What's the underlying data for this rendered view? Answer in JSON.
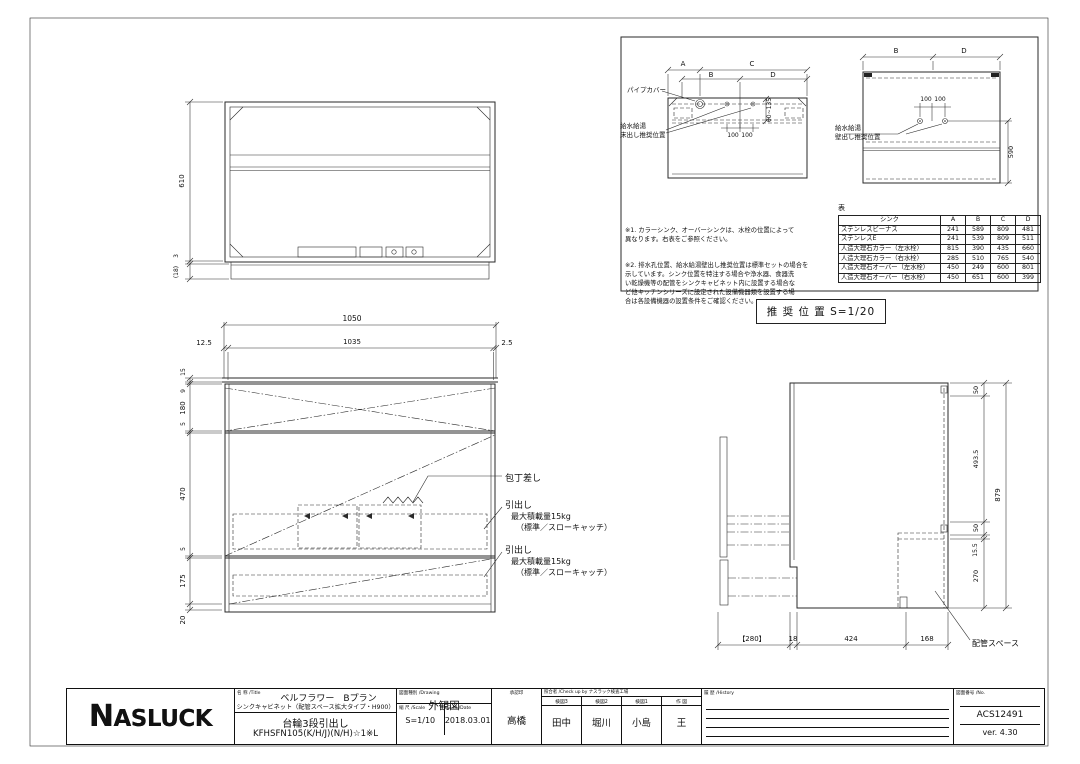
{
  "top_view": {
    "dim_height": "610",
    "dim_edge": "3",
    "dim_base": "(18)"
  },
  "front_view": {
    "dim_total_w": "1050",
    "dim_l": "12.5",
    "dim_inner_w": "1035",
    "dim_r": "2.5",
    "dims_left": [
      "15",
      "9",
      "180",
      "5",
      "470",
      "5",
      "175",
      "20"
    ],
    "label_knife": "包丁差し",
    "drawer_label": {
      "line1": "引出し",
      "line2": "最大積載量15kg",
      "line3": "（標準／スローキャッチ）"
    }
  },
  "side_view": {
    "dims_right": [
      "50",
      "493.5",
      "50",
      "15.5",
      "270"
    ],
    "dim_total_h": "879",
    "dims_bottom": [
      "【280】",
      "18",
      "424",
      "168"
    ],
    "label_piping": "配管スペース"
  },
  "recommend": {
    "caption": "推 奨 位 置  S=1/20",
    "floor": {
      "dim_a": "A",
      "dim_b": "B",
      "dim_c": "C",
      "dim_d": "D",
      "label_pipe_cover": "パイプカバー",
      "label_line1": "給水給湯",
      "label_line2": "床出し推奨位置",
      "dim_100": "100",
      "dim_range": "60~135"
    },
    "wall": {
      "dim_b": "B",
      "dim_d": "D",
      "label_line1": "給水給湯",
      "label_line2": "壁出し推奨位置",
      "dim_100": "100",
      "dim_height": "590"
    },
    "note1": "※1. カラーシンク、オーバーシンクは、水栓の位置によって\n異なります。右表をご参照ください。",
    "note2": "※2. 排水孔位置、給水給湯壁出し推奨位置は標準セットの場合を\n示しています。シンク位置を特注する場合や浄水器、食器洗\nい乾燥機等の配管をシンクキャビネット内に設置する場合な\nど他キッチンシリーズに設定された設備機器類を設置する場\n合は各設備機器の設置条件をご確認ください。",
    "table": {
      "caption": "表",
      "headers": [
        "シンク",
        "A",
        "B",
        "C",
        "D"
      ],
      "rows": [
        [
          "ステンレスビーナス",
          "241",
          "589",
          "809",
          "481"
        ],
        [
          "ステンレスE",
          "241",
          "539",
          "809",
          "511"
        ],
        [
          "人造大理石カラー（左水栓）",
          "815",
          "390",
          "435",
          "660"
        ],
        [
          "人造大理石カラー（右水栓）",
          "285",
          "510",
          "765",
          "540"
        ],
        [
          "人造大理石オーバー（左水栓）",
          "450",
          "249",
          "600",
          "801"
        ],
        [
          "人造大理石オーバー（右水栓）",
          "450",
          "651",
          "600",
          "399"
        ]
      ]
    }
  },
  "title_block": {
    "logo": "ASLUCK",
    "logo_initial": "N",
    "name_header": "名 称 /Title",
    "name_line1": "ベルフラワー　Bプラン",
    "name_line2": "シンクキャビネット（配管スペース拡大タイプ・H900）",
    "name_line3": "台輪3段引出し",
    "name_line4": "KFHSFN105(K/H/J)(N/H)☆1※L",
    "drawing_header": "図面種別 /Drawing",
    "drawing_type": "外観図",
    "scale_header": "縮 尺 /Scale",
    "scale_value": "S=1/10",
    "date_header": "日 付 /Date",
    "date_value": "2018.03.01",
    "approval_header": "承認印",
    "approval_name": "高橋",
    "check_header": "照合者 /Check up by ナスラック検査工場",
    "check_cols": [
      {
        "header": "検図3",
        "name": "田中"
      },
      {
        "header": "検図2",
        "name": "堀川"
      },
      {
        "header": "検図1",
        "name": "小島"
      },
      {
        "header": "作 図",
        "name": "王"
      }
    ],
    "history_header": "履 歴 /History",
    "number_header": "図面番号 /No.",
    "number_value": "ACS12491",
    "version": "ver. 4.30"
  }
}
